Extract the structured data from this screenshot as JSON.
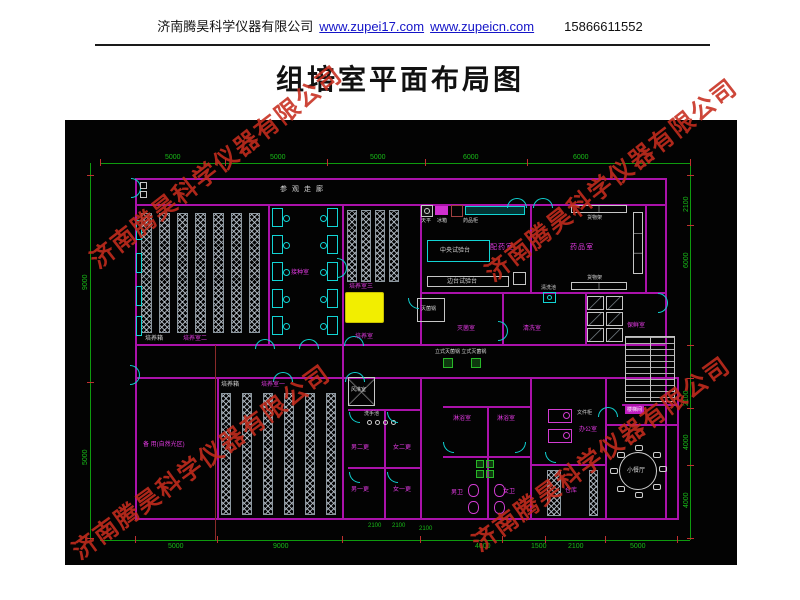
{
  "header": {
    "company": "济南腾昊科学仪器有限公司",
    "url1": "www.zupei17.com",
    "url2": "www.zupeicn.com",
    "phone": "15866611552"
  },
  "title": "组培室平面布局图",
  "watermark": {
    "text": "济南腾昊科学仪器有限公司"
  },
  "colors": {
    "wall": "#ab12ab",
    "door": "#0fd0d0",
    "dimension": "#0e9a0e",
    "room_label": "#e23ae2",
    "highlight": "#f2ee00",
    "watermark": "#c62c1e",
    "link": "#1515c8"
  },
  "plan": {
    "corridor": "参观走廊",
    "rooms": {
      "pys1": "培养室一",
      "pys2": "培养室二",
      "pys3": "培养室三",
      "pys0": "培养室",
      "jzs": "接种室",
      "pyaos": "配药室",
      "yps": "药品室",
      "mjs": "灭菌室",
      "qxs": "清洗室",
      "bxs": "保鲜室",
      "lys": "淋浴室",
      "nwei": "男卫",
      "nvwei": "女卫",
      "bgs": "办公室",
      "ck": "仓库",
      "n2g": "男二更",
      "v2g": "女二更",
      "n1g": "男一更",
      "v1g": "女一更",
      "beiyong": "备 用(自然光区)",
      "xct": "小餐厅"
    },
    "equipment": {
      "pyx": "培养箱",
      "zysyt": "中央试验台",
      "btsyt": "边台试验台",
      "tianping": "天平",
      "bingxiang": "冰箱",
      "ypg": "药品柜",
      "hwj": "货物架",
      "mjg": "灭菌锅",
      "qxc": "清洗池",
      "lsmjg": "立式灭菌锅 立式灭菌锅",
      "fls": "风淋室",
      "xsc": "洗手池",
      "wjg": "文件柜",
      "lt": "楼梯间"
    },
    "dims": {
      "top": [
        "5000",
        "5000",
        "5000",
        "6000",
        "6000"
      ],
      "left": [
        "9000",
        "5000"
      ],
      "right": [
        "2100",
        "6000",
        "2100",
        "4000",
        "4000"
      ],
      "bottom": [
        "5000",
        "9000",
        "4000",
        "1500",
        "2100",
        "5000"
      ],
      "inner": [
        "2100",
        "2100",
        "2100"
      ]
    }
  }
}
